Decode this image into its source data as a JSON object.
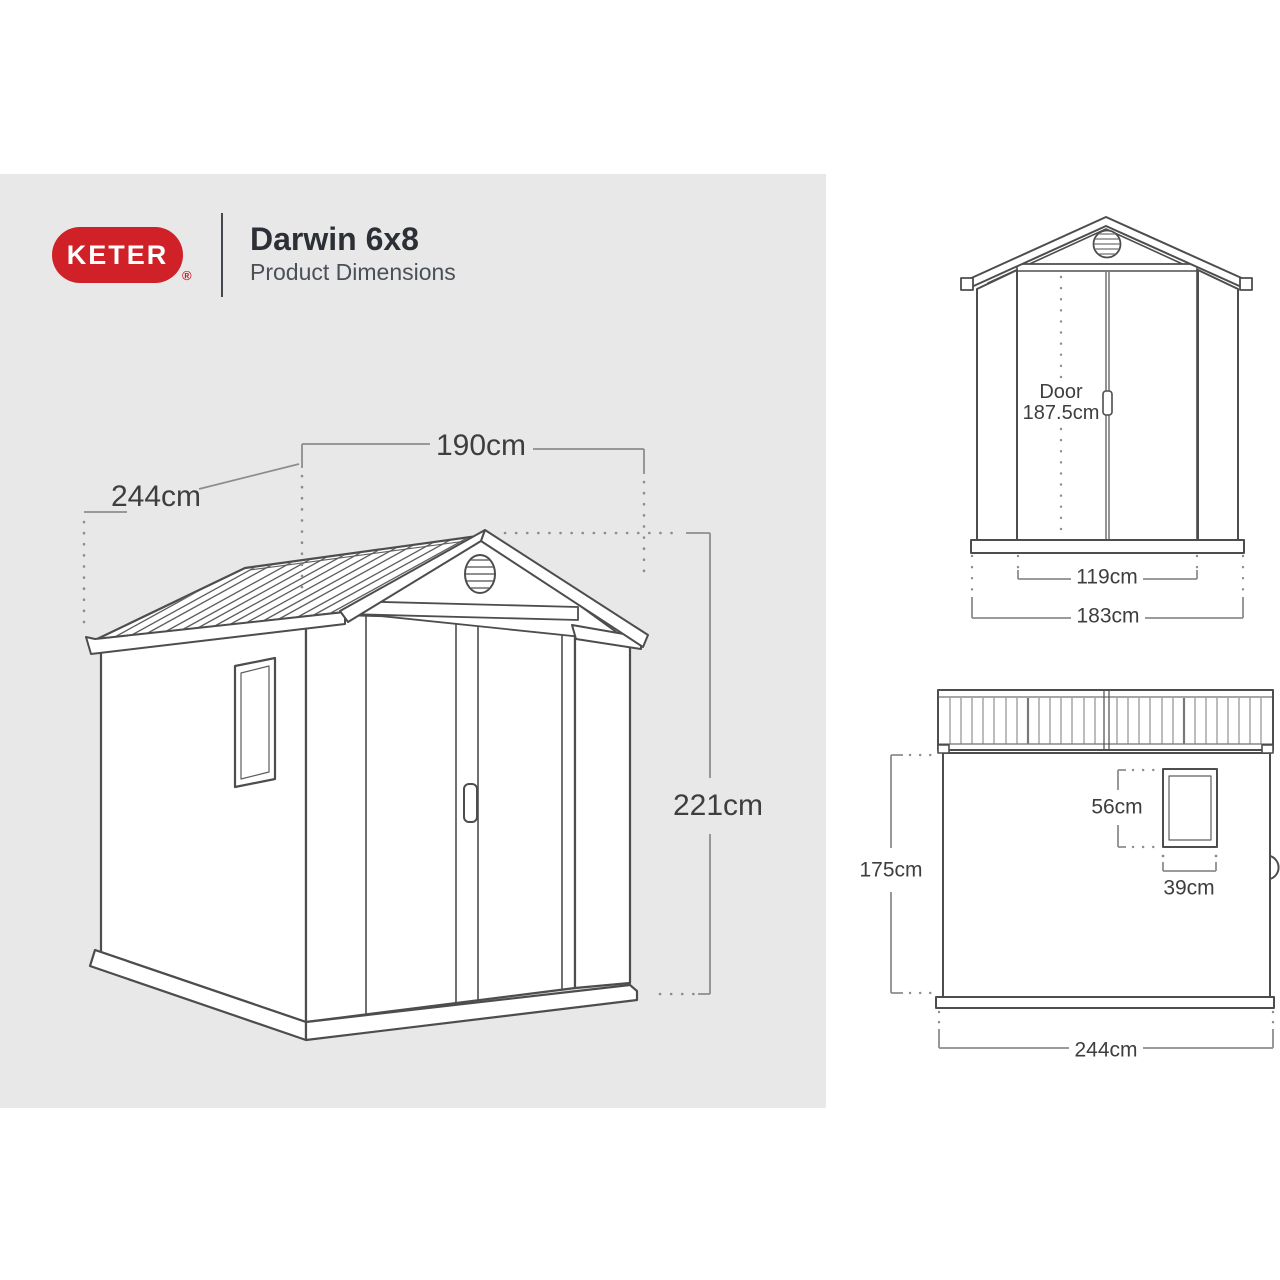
{
  "header": {
    "brand": "KETER",
    "registered_mark": "®",
    "product_name": "Darwin 6x8",
    "subtitle": "Product Dimensions",
    "brand_color": "#cf2127"
  },
  "perspective_view": {
    "width": "190cm",
    "depth": "244cm",
    "height": "221cm"
  },
  "front_view": {
    "door_label": "Door",
    "door_height": "187.5cm",
    "door_width": "119cm",
    "overall_width": "183cm"
  },
  "side_view": {
    "wall_height": "175cm",
    "window_height": "56cm",
    "window_width": "39cm",
    "depth": "244cm"
  },
  "colors": {
    "panel_gray": "#e8e8e8",
    "line_dark": "#4d4d4d",
    "dimension_gray": "#8d8d8d",
    "text_dark": "#3e3e3e",
    "brand_red": "#cf2127"
  }
}
